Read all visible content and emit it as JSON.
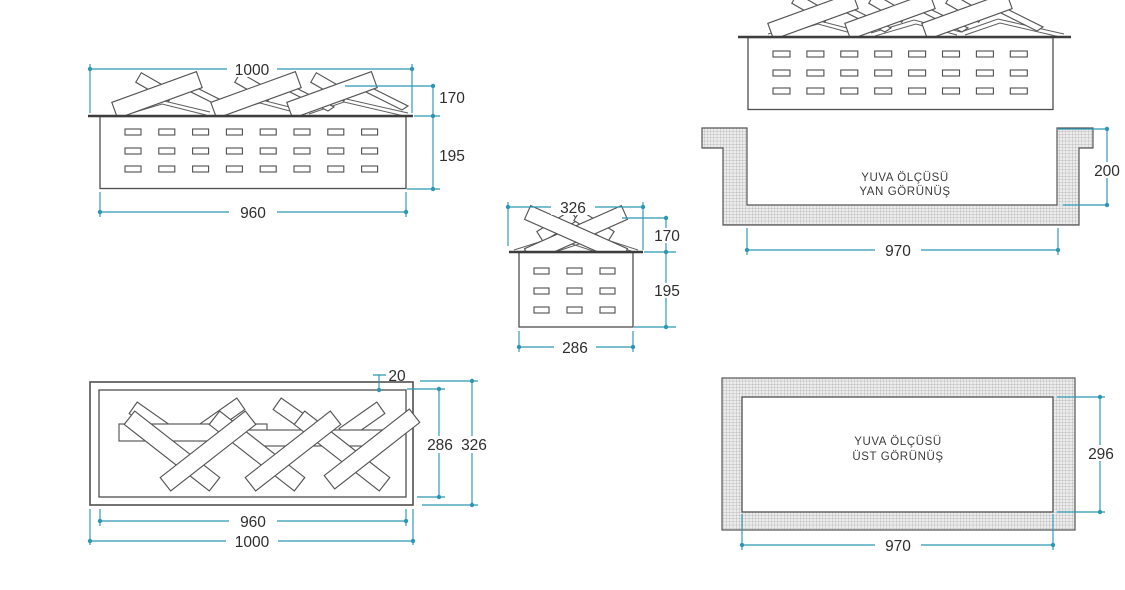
{
  "colors": {
    "dimension_line": "#2b97b3",
    "drawing_line": "#4f4f4f",
    "hatch_fill": "#ededed"
  },
  "views": {
    "burner_front": {
      "dims": {
        "top_width": "1000",
        "log_height": "170",
        "body_height": "195",
        "bottom_width": "960"
      }
    },
    "burner_side": {
      "dims": {
        "top_width": "326",
        "log_height": "170",
        "body_height": "195",
        "bottom_width": "286"
      }
    },
    "recess_side": {
      "label_line1": "YUVA ÖLÇÜSÜ",
      "label_line2": "YAN GÖRÜNÜŞ",
      "dims": {
        "depth": "200",
        "width": "970"
      }
    },
    "burner_top": {
      "dims": {
        "lip_offset": "20",
        "inner_depth": "286",
        "outer_depth": "326",
        "inner_width": "960",
        "outer_width": "1000"
      }
    },
    "recess_top": {
      "label_line1": "YUVA ÖLÇÜSÜ",
      "label_line2": "ÜST GÖRÜNÜŞ",
      "dims": {
        "depth": "296",
        "width": "970"
      }
    }
  }
}
